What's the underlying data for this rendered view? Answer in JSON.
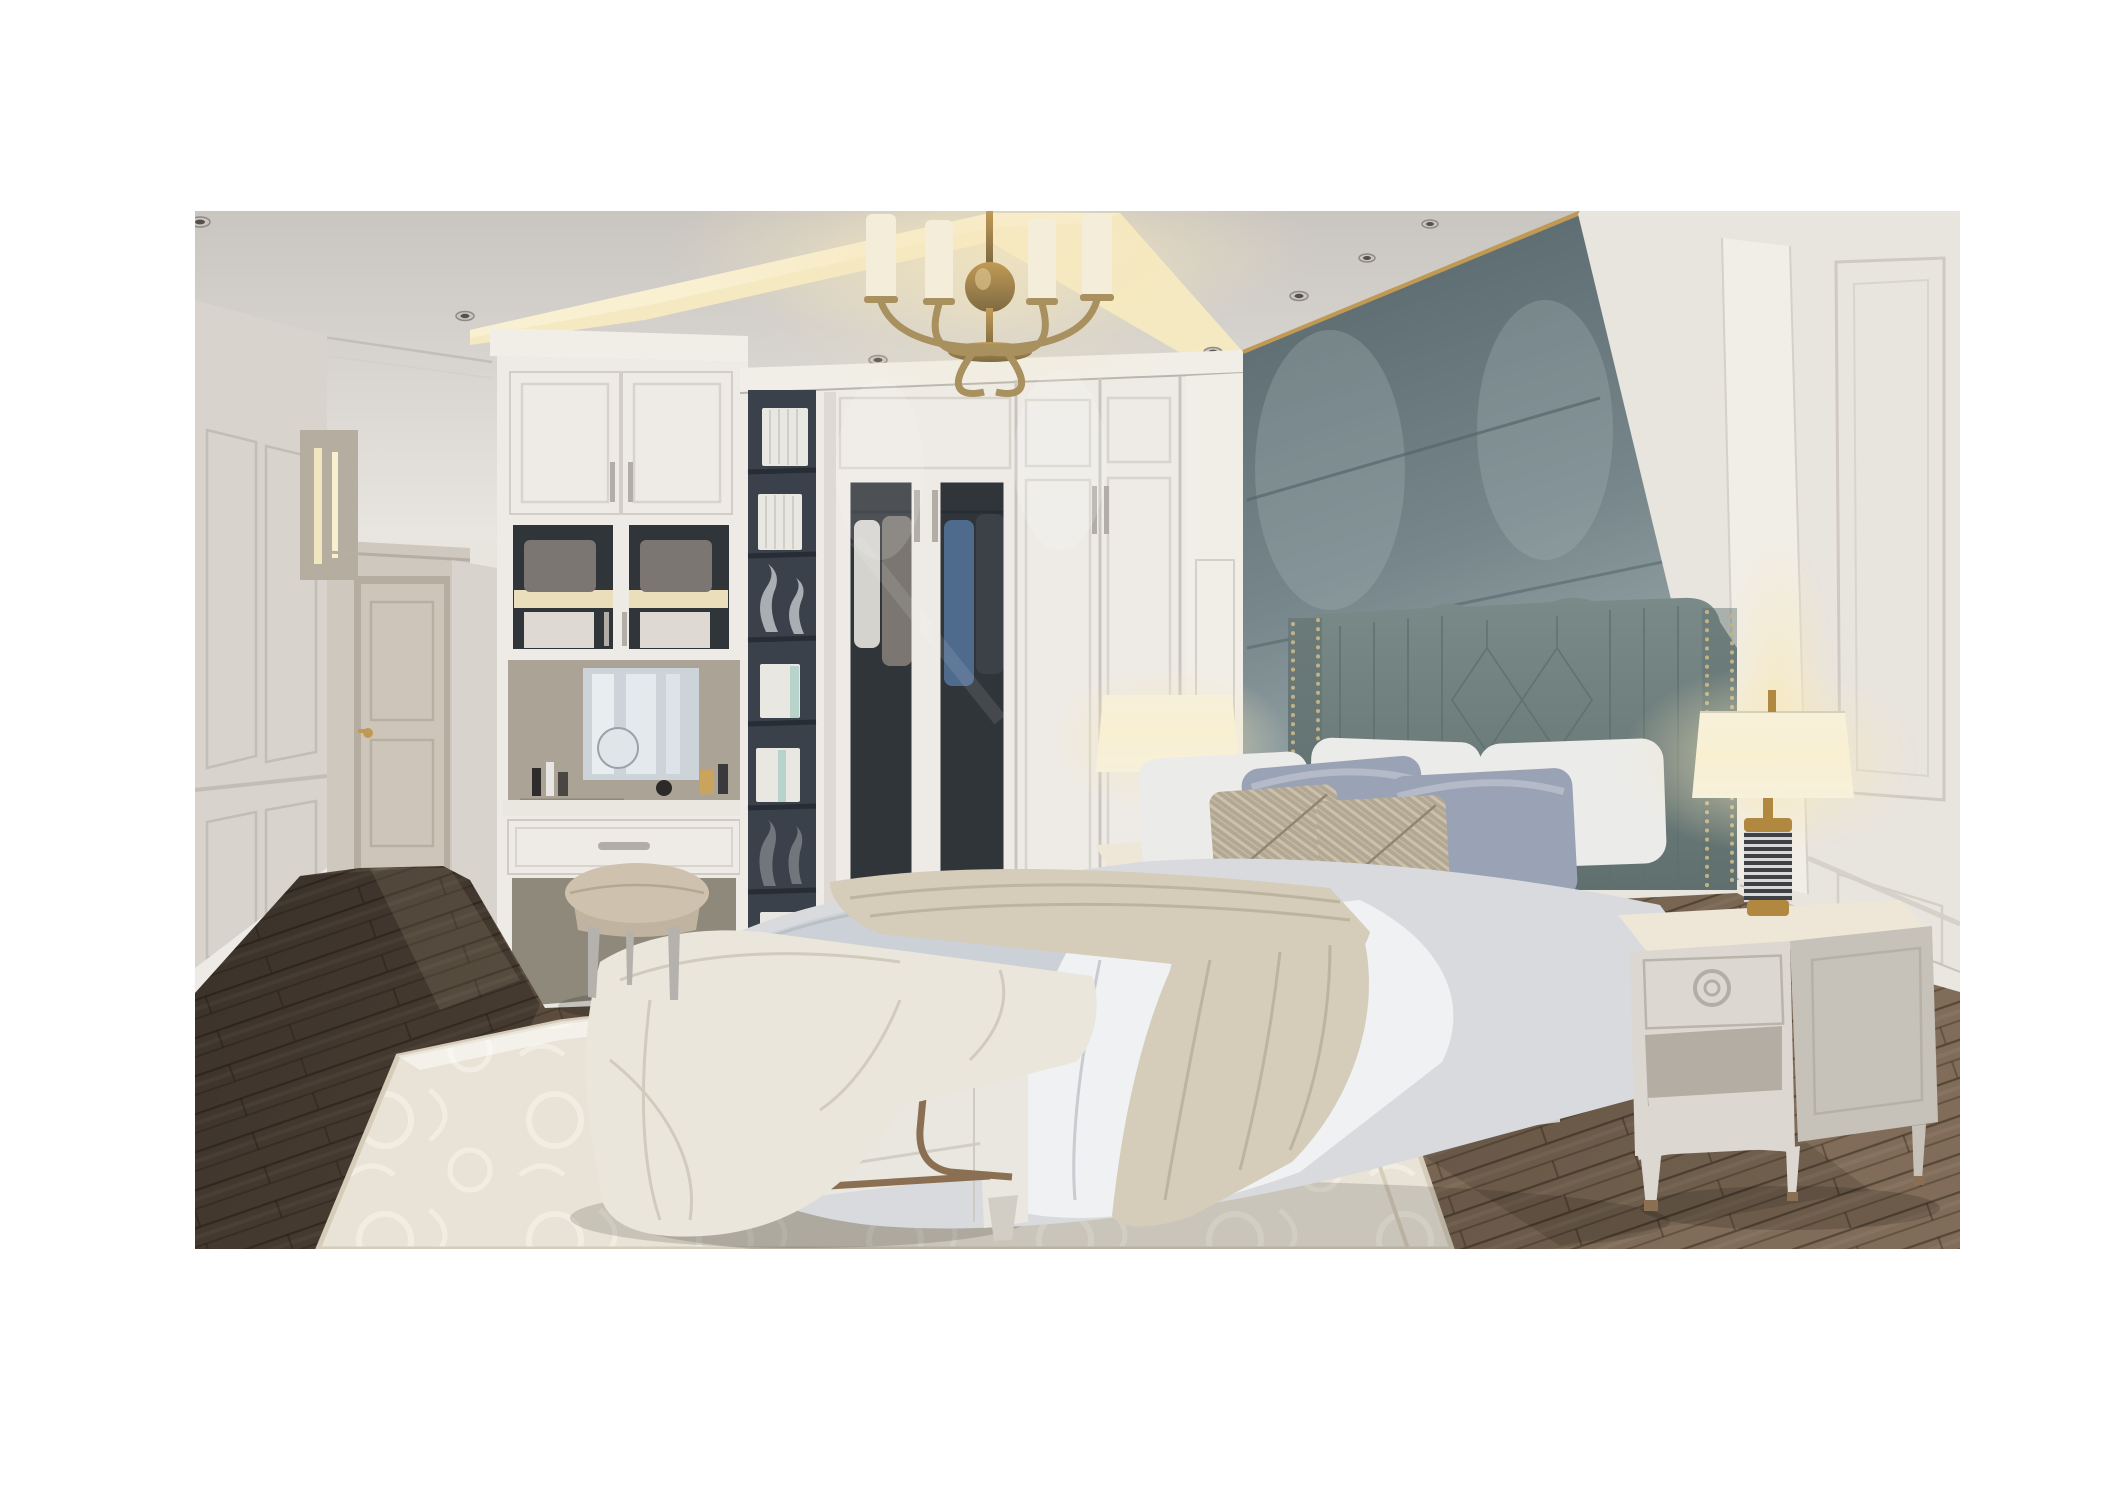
{
  "meta": {
    "kind": "photoreal-render",
    "scene": "luxury-neoclassical-bedroom",
    "objects": [
      "ceiling-cove",
      "chandelier",
      "recessed-downlights",
      "hallway-door",
      "wainscot-walls",
      "built-in-wardrobe",
      "glass-display-cabinet",
      "bookshelf-niche",
      "vanity-with-mirror",
      "vanity-stool",
      "upholstered-accent-wall",
      "bed-with-channel-headboard",
      "pillows",
      "duvet",
      "throw-blanket",
      "nightstands",
      "table-lamps",
      "upholstered-bench",
      "area-rug",
      "wood-floor"
    ]
  },
  "palette": {
    "white": "#ffffff",
    "ceiling_top": "#c9c5c0",
    "ceiling": "#e9e6e1",
    "cove": "#f5e9c2",
    "cove_bright": "#f9f0d2",
    "wall_left": "#d8d3cc",
    "wall_hall": "#cfc8bf",
    "door": "#cdc5b9",
    "door_shadow": "#b5ad9f",
    "wardrobe": "#eeebe6",
    "wardrobe_shadow": "#ded9d2",
    "wardrobe_line": "#c9c4bd",
    "handle": "#b2aea7",
    "glass_dark": "#30353a",
    "clothes_light": "#d5d3ce",
    "clothes_gray": "#7b7672",
    "clothes_blue": "#4e6a8d",
    "clothes_dark": "#3c4148",
    "shelf_dark": "#3a414a",
    "shelf_line": "#272d34",
    "book_white": "#e9e7e2",
    "book_teal": "#b8d2cc",
    "vase_silver": "#a8aeb2",
    "vase_dark": "#70767c",
    "niche_back": "#aba496",
    "niche_shadow": "#8f897c",
    "mirror_light": "#e8edf0",
    "mirror_base": "#ccd4d9",
    "accent_dark": "#546468",
    "accent": "#76868a",
    "accent_light": "#a9b6b8",
    "brass": "#c09a55",
    "wall_right": "#e8e4de",
    "pilaster": "#f1eee8",
    "headboard": "#7a8a88",
    "headboard_dark": "#60706f",
    "nailhead": "#c2b287",
    "pillow_white": "#ebebe9",
    "pillow_lav": "#9aa2b6",
    "pillow_lav_light": "#bac0cd",
    "pillow_beige": "#b2a793",
    "pillow_beige_light": "#d3c9b2",
    "bedding": "#d8dade",
    "bedding_white": "#f0f1f2",
    "bedding_shadow": "#b7bcc2",
    "duvet_gray": "#ccd1d7",
    "throw": "#d5ccba",
    "throw_deep": "#b9ae99",
    "bench_throw": "#eae6db",
    "frame_white": "#eae7e1",
    "frame_shadow": "#d2cec6",
    "floor_dark": "#4a3f35",
    "floor_mid": "#695847",
    "floor_light": "#806c58",
    "rug": "#e8e3d6",
    "rug_dark": "#d5cdb9",
    "rug_pattern": "#f3efe4",
    "nightstand": "#dcd7d0",
    "nightstand_dark": "#c6c1b9",
    "nightstand_top": "#eee6d6",
    "lamp_shade": "#f7f0da",
    "lamp_brass": "#b0883f",
    "lamp_body_dark": "#3f4144",
    "lamp_body_light": "#d9d9d9",
    "bench_teal": "#2e5a66",
    "bench_gold": "#bf9240",
    "bench_bronze": "#8a6f52",
    "stool_leather": "#cec2ae",
    "stool_skirt": "#c0b4a0",
    "stool_leg": "#b5b2ad",
    "chand_brass": "#a8905f",
    "chand_brass_dark": "#7e6a42",
    "chand_shade": "#f4edda",
    "shadow": "#000000"
  }
}
